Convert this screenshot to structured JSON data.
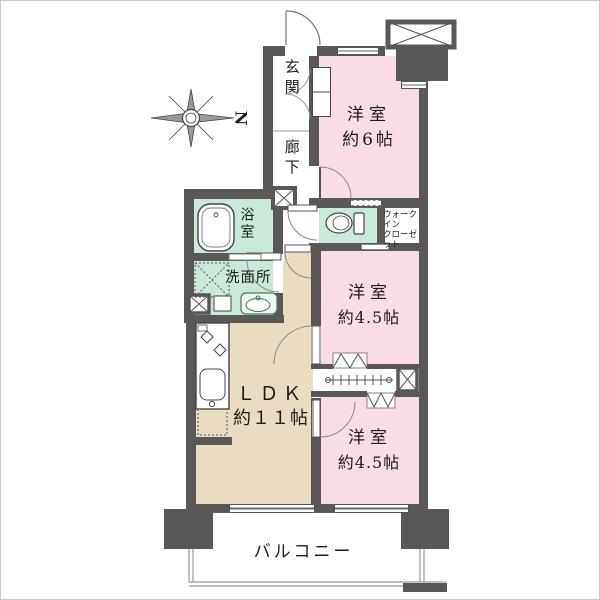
{
  "colors": {
    "wall": "#5a5857",
    "bedroom_pink": "#f9dce6",
    "wet_area_green": "#c9e9d9",
    "ldk_tan": "#e9dcc0"
  },
  "compass": {
    "north_label": "N"
  },
  "rooms": {
    "entrance": {
      "label": "玄関"
    },
    "corridor": {
      "label": "廊下"
    },
    "bedroom1": {
      "label": "洋室",
      "size": "約6帖"
    },
    "wic": {
      "label_line1": "ウォークイン",
      "label_line2": "クローゼット"
    },
    "bathroom": {
      "label": "浴室"
    },
    "washroom": {
      "label": "洗面所"
    },
    "bedroom2": {
      "label": "洋室",
      "size": "約4.5帖"
    },
    "ldk": {
      "label": "ＬＤＫ",
      "size": "約１１帖"
    },
    "bedroom3": {
      "label": "洋室",
      "size": "約4.5帖"
    },
    "balcony": {
      "label": "バルコニー"
    }
  }
}
